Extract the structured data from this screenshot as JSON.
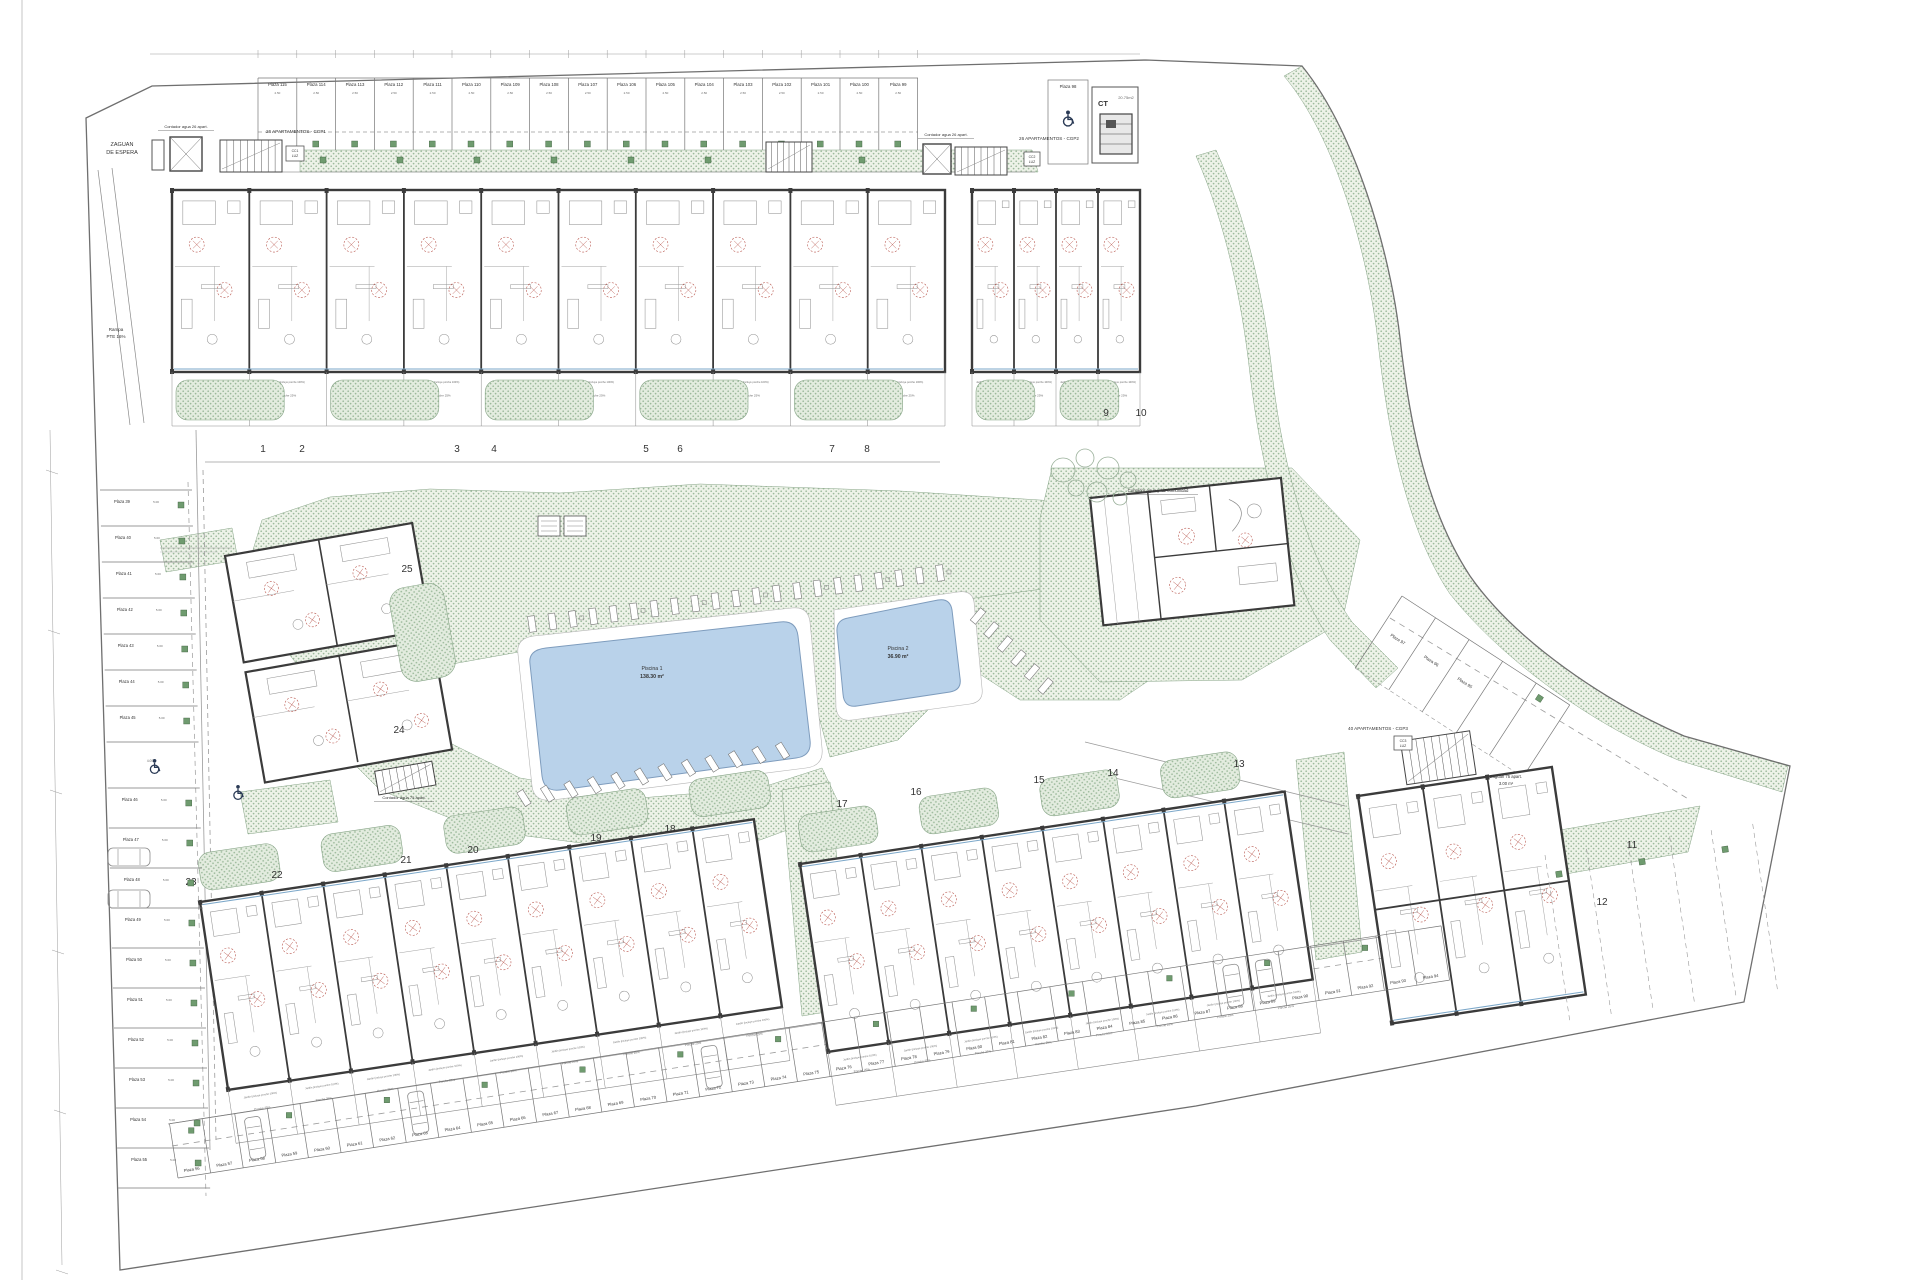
{
  "colors": {
    "page_bg": "#ffffff",
    "boundary": "#6f6f6f",
    "wall": "#3b3b3b",
    "line_light": "#9b9b9b",
    "green_dot": "#8fb08f",
    "green_bg": "#edf2e8",
    "hedge_stroke": "#85a385",
    "pool_fill": "#b9d2ea",
    "pool_stroke": "#7e9cbd",
    "pool_text": "#3d4f66",
    "door_arc_red": "#b0443a",
    "terrace_blue": "#7ba7c9",
    "marker_green": "#6f9b6f",
    "text_dark": "#333333",
    "text_dim": "#666666"
  },
  "parking": {
    "top_row": [
      "Plaza 115",
      "Plaza 114",
      "Plaza 113",
      "Plaza 112",
      "Plaza 111",
      "Plaza 110",
      "Plaza 109",
      "Plaza 108",
      "Plaza 107",
      "Plaza 106",
      "Plaza 105",
      "Plaza 104",
      "Plaza 103",
      "Plaza 102",
      "Plaza 101",
      "Plaza 100",
      "Plaza 99"
    ],
    "top_extra": "Plaza 98",
    "left_column": [
      "Plaza 39",
      "Plaza 40",
      "Plaza 41",
      "Plaza 42",
      "Plaza 43",
      "Plaza 44",
      "Plaza 45",
      "Plaza 46",
      "Plaza 47",
      "Plaza 48",
      "Plaza 49",
      "Plaza 50",
      "Plaza 51",
      "Plaza 52",
      "Plaza 53",
      "Plaza 54",
      "Plaza 55"
    ],
    "bottom_row": [
      "Plaza 56",
      "Plaza 57",
      "Plaza 58",
      "Plaza 59",
      "Plaza 60",
      "Plaza 61",
      "Plaza 62",
      "Plaza 63",
      "Plaza 64",
      "Plaza 65",
      "Plaza 66",
      "Plaza 67",
      "Plaza 68",
      "Plaza 69",
      "Plaza 70",
      "Plaza 71",
      "Plaza 72",
      "Plaza 73",
      "Plaza 74",
      "Plaza 75",
      "Plaza 76",
      "Plaza 77",
      "Plaza 78",
      "Plaza 79",
      "Plaza 80",
      "Plaza 81",
      "Plaza 82",
      "Plaza 83",
      "Plaza 84",
      "Plaza 85",
      "Plaza 86",
      "Plaza 87",
      "Plaza 88",
      "Plaza 89",
      "Plaza 90",
      "Plaza 91",
      "Plaza 92",
      "Plaza 93",
      "Plaza 94"
    ],
    "right_diagonal": [
      "Plaza 97",
      "Plaza 96",
      "Plaza 95"
    ],
    "stall_width_dim": "2.50",
    "stall_depth_dim": "5.00",
    "gap_dim": "4.00"
  },
  "pools": [
    {
      "name": "Piscina 1",
      "area": "138.30 m²"
    },
    {
      "name": "Piscina 2",
      "area": "36.90 m²"
    }
  ],
  "plot_numbers": {
    "top_row": [
      "1",
      "2",
      "3",
      "4",
      "5",
      "6",
      "7",
      "8"
    ],
    "top_right": [
      "9",
      "10"
    ],
    "mid_left": [
      "25",
      "24"
    ],
    "bottom_left": [
      "23",
      "22",
      "21",
      "20",
      "19",
      "18"
    ],
    "bottom_middle": [
      "17",
      "16",
      "15",
      "14",
      "13"
    ],
    "bottom_right": [
      "11",
      "12"
    ]
  },
  "buildings": {
    "cgp1_label": "26 APARTAMENTOS - CGP1",
    "cgp2_label": "26 APARTAMENTOS - CGP2",
    "cgp3_label": "40 APARTAMENTOS - CGP3",
    "ct_label": "CT",
    "ct_area": "20.75m2"
  },
  "unit_texts": {
    "porche": "Porche 25%",
    "jardin": "Jardín (incluye porche 100%)"
  },
  "annotations": {
    "zaguan_espera": [
      "ZAGUAN",
      "DE ESPERA"
    ],
    "contador_a": "Contador agua 26 apart.",
    "contador_b": "Contador agua 26 apart.",
    "contador_comunidad": "Contador agua y luz comunidad",
    "contador_75": "Contador agua 75 apart.",
    "zaguan_75": [
      "Zaguán 75 apart.",
      "3.00 m²"
    ],
    "rampa": [
      "Rampa",
      "PTE 16%"
    ],
    "cc1": [
      "CC1",
      "LUZ"
    ],
    "cc2": [
      "CC2",
      "LUZ"
    ],
    "cc3": [
      "CC3",
      "LUZ"
    ]
  }
}
